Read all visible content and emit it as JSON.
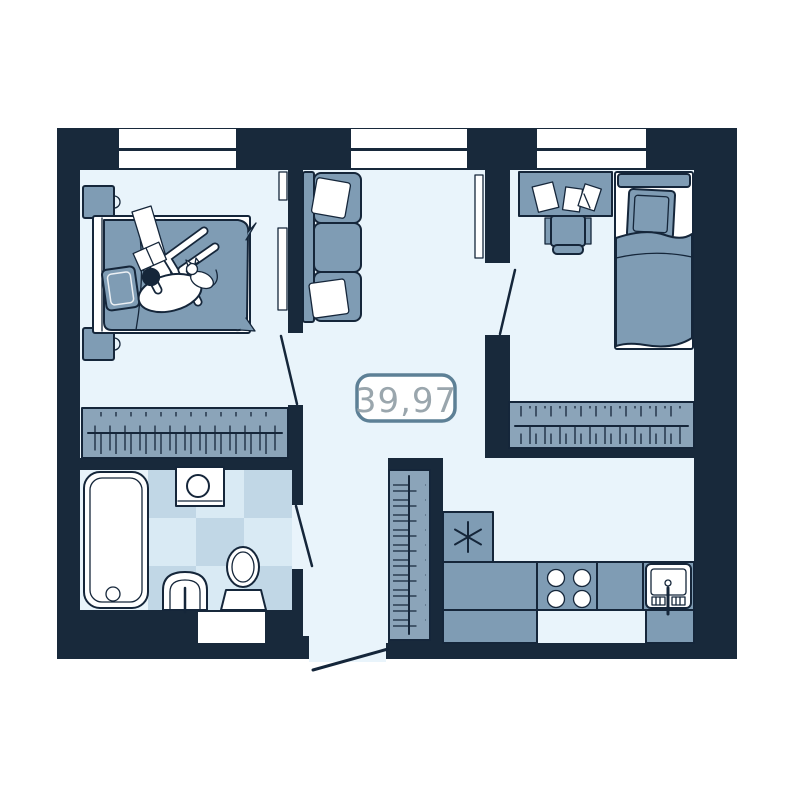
{
  "floor_plan": {
    "area_label": "39,97",
    "windows_count": 3,
    "colors": {
      "wall": "#18293b",
      "floor": "#e9f4fb",
      "furniture": "#7f9cb4",
      "furniture_light": "#8ba4b9",
      "tile_light": "#d9eaf4",
      "tile_dark": "#c1d7e6",
      "white": "#ffffff",
      "outline": "#15263a",
      "label_border": "#5d8096",
      "label_text": "#9aa6ad"
    },
    "rooms": [
      "bedroom-1",
      "living-room",
      "bedroom-2",
      "bathroom",
      "kitchen",
      "hallway"
    ],
    "furniture_items": [
      "double-bed",
      "nightstand",
      "tv-panel",
      "sofa",
      "desk",
      "desk-chair",
      "single-bed",
      "wardrobe",
      "bathtub",
      "washing-machine",
      "toilet",
      "bathroom-sink",
      "fridge",
      "stove",
      "kitchen-sink",
      "kitchen-counter"
    ]
  }
}
